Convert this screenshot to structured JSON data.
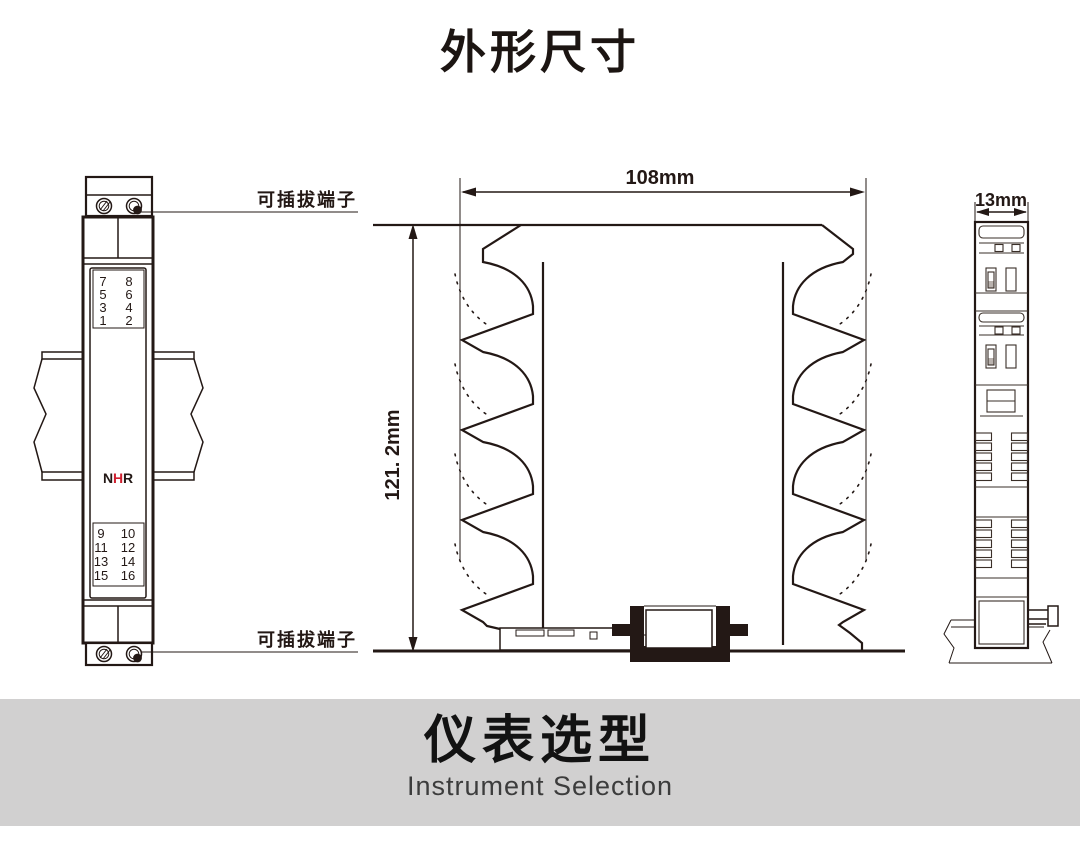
{
  "title": "外形尺寸",
  "labels": {
    "pluggable_terminal_top": "可插拔端子",
    "pluggable_terminal_bottom": "可插拔端子"
  },
  "dimensions": {
    "width": "108mm",
    "height": "121. 2mm",
    "depth": "13mm"
  },
  "left_module": {
    "logo": {
      "n": "N",
      "h": "H",
      "r": "R"
    },
    "top_terminals": [
      [
        "7",
        "8"
      ],
      [
        "5",
        "6"
      ],
      [
        "3",
        "4"
      ],
      [
        "1",
        "2"
      ]
    ],
    "bottom_terminals": [
      [
        "9",
        "10"
      ],
      [
        "11",
        "12"
      ],
      [
        "13",
        "14"
      ],
      [
        "15",
        "16"
      ]
    ]
  },
  "footer": {
    "title": "仪表选型",
    "subtitle": "Instrument Selection",
    "band_color": "#d1d0d0"
  },
  "colors": {
    "line": "#231815",
    "logo_red": "#cf2030",
    "footer_band": "#d1d0d0"
  }
}
